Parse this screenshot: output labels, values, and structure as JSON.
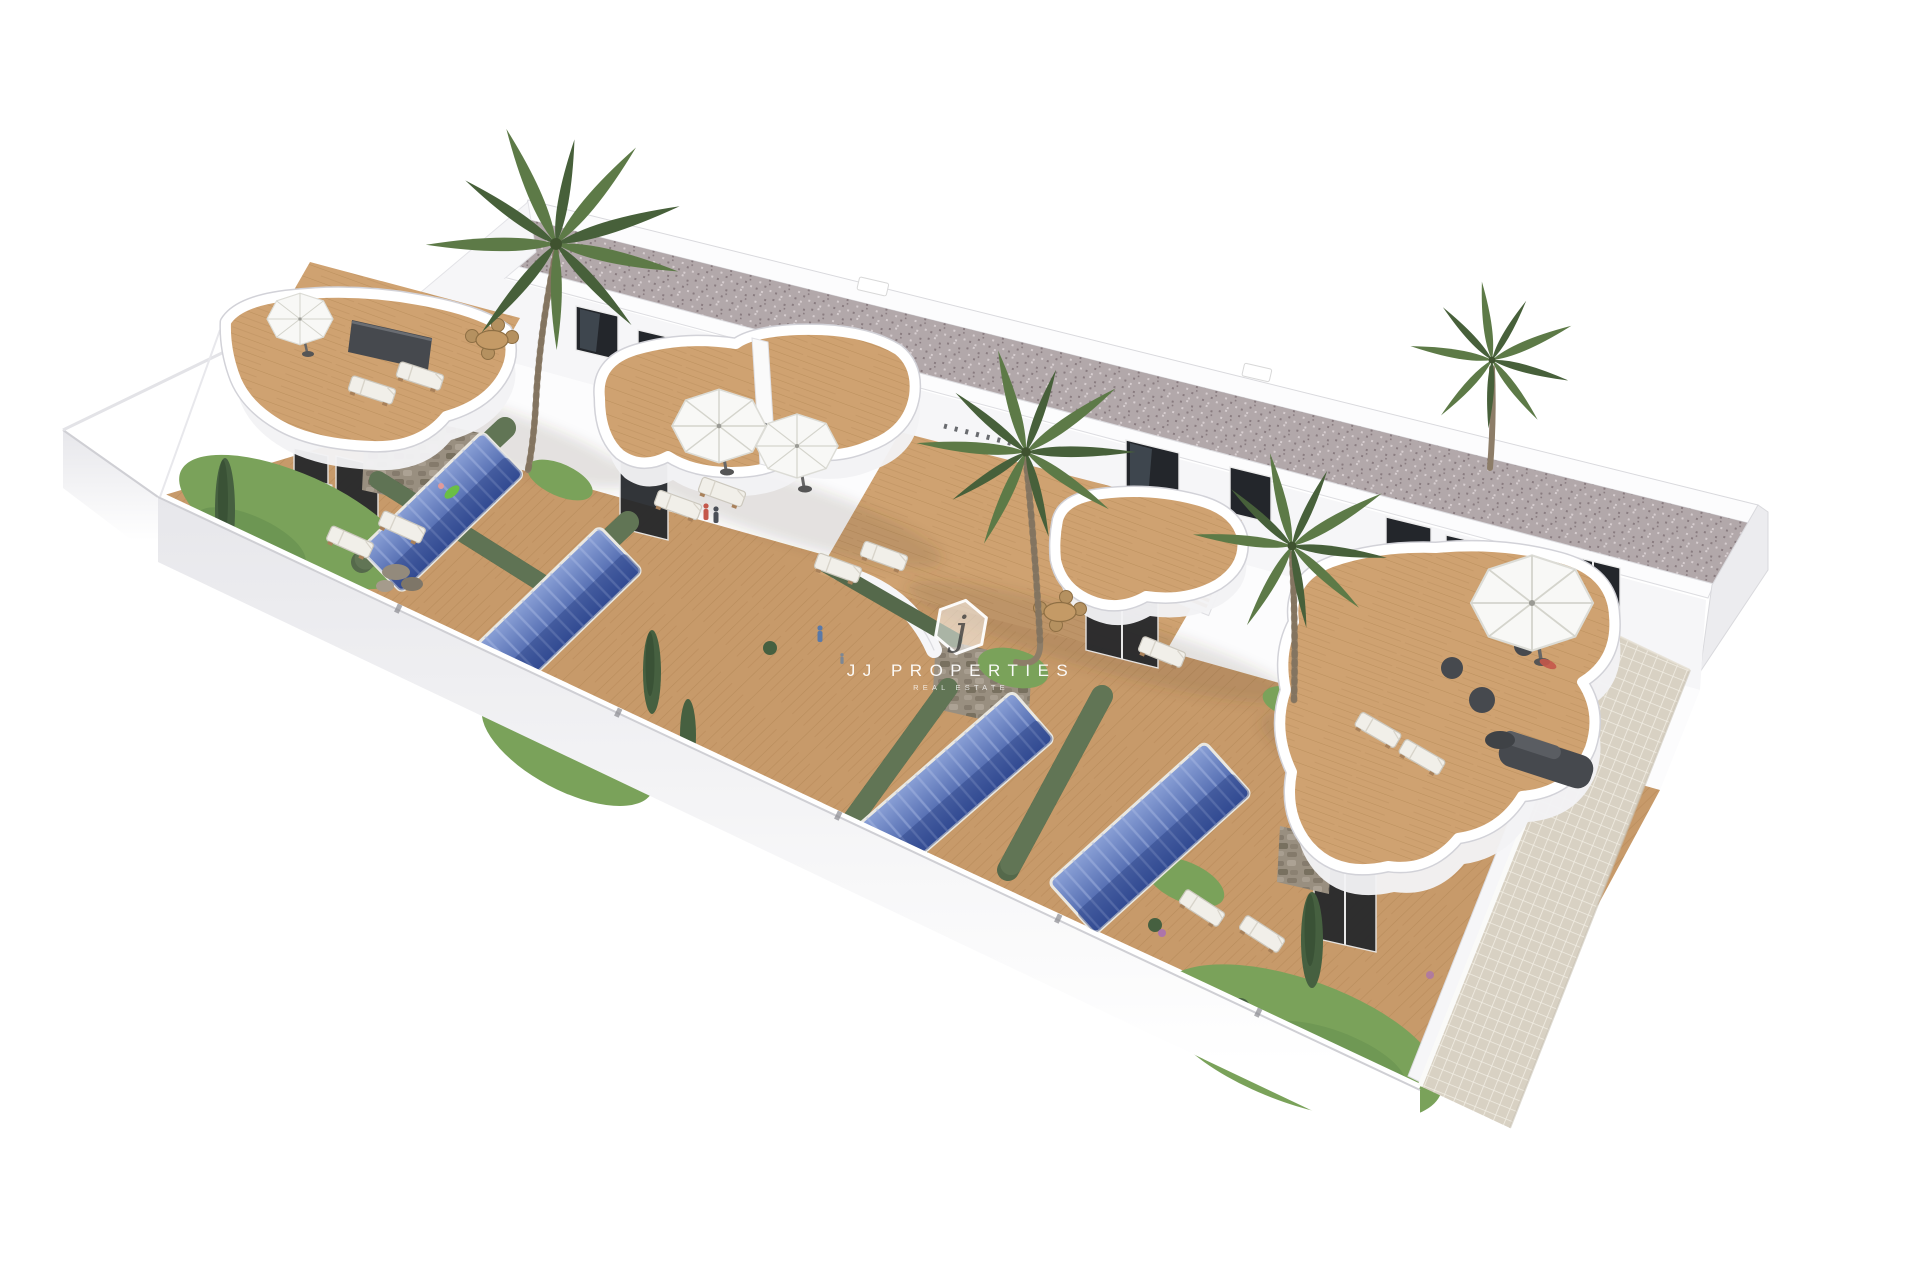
{
  "page": {
    "title": "Aerial 3D render of terraced houses with private pools"
  },
  "watermark": {
    "monogram": "j",
    "brand": "JJ PROPERTIES",
    "tagline": "REAL ESTATE"
  },
  "scene": {
    "description": "White two-storey terraced residential block with gravel flat roof, curved white roof terraces with wooden decks, four private gardens each with a rectangular blue pool, hedges, palm trees, sun loungers, parasols and a tiled walkway along the right perimeter wall.",
    "pools_visible": 4,
    "palm_trees_visible": 4,
    "parasols_visible": 4,
    "townhouse_units_visible": 4
  },
  "colors": {
    "roof-speckle-base": "#b2a8aa",
    "roof-speckle-dark": "#897c80",
    "roof-speckle-light": "#d6cdcf",
    "wall-white": "#fcfcfd",
    "facade-white": "#f6f6f8",
    "facade-shade": "#ececef",
    "window-dark": "#23262b",
    "window-lite": "#55606c",
    "deck-wood": "#c79a6a",
    "terrace-wood": "#cfa271",
    "plank-line": "#aa7d4c",
    "pool-deep": "#35509c",
    "pool-light": "#8aa0d6",
    "pool-slat": "#a6b8e2",
    "hedge-green": "#55694b",
    "hedge-light": "#708462",
    "grass-green": "#7aa25a",
    "grass-dark": "#689150",
    "palm-green": "#5d7a47",
    "palm-dark": "#47603a",
    "cypress-green": "#466040",
    "stone-gray": "#998f80",
    "tile-beige": "#d8d1c3",
    "tile-grout": "#f1ede3",
    "umbrella-white": "#f8f8f6",
    "lounger-white": "#f1efe9",
    "furniture-dark": "#46494e",
    "trunk-brown": "#8d7d68",
    "soft-shadow": "rgba(80,65,50,0.14)"
  }
}
